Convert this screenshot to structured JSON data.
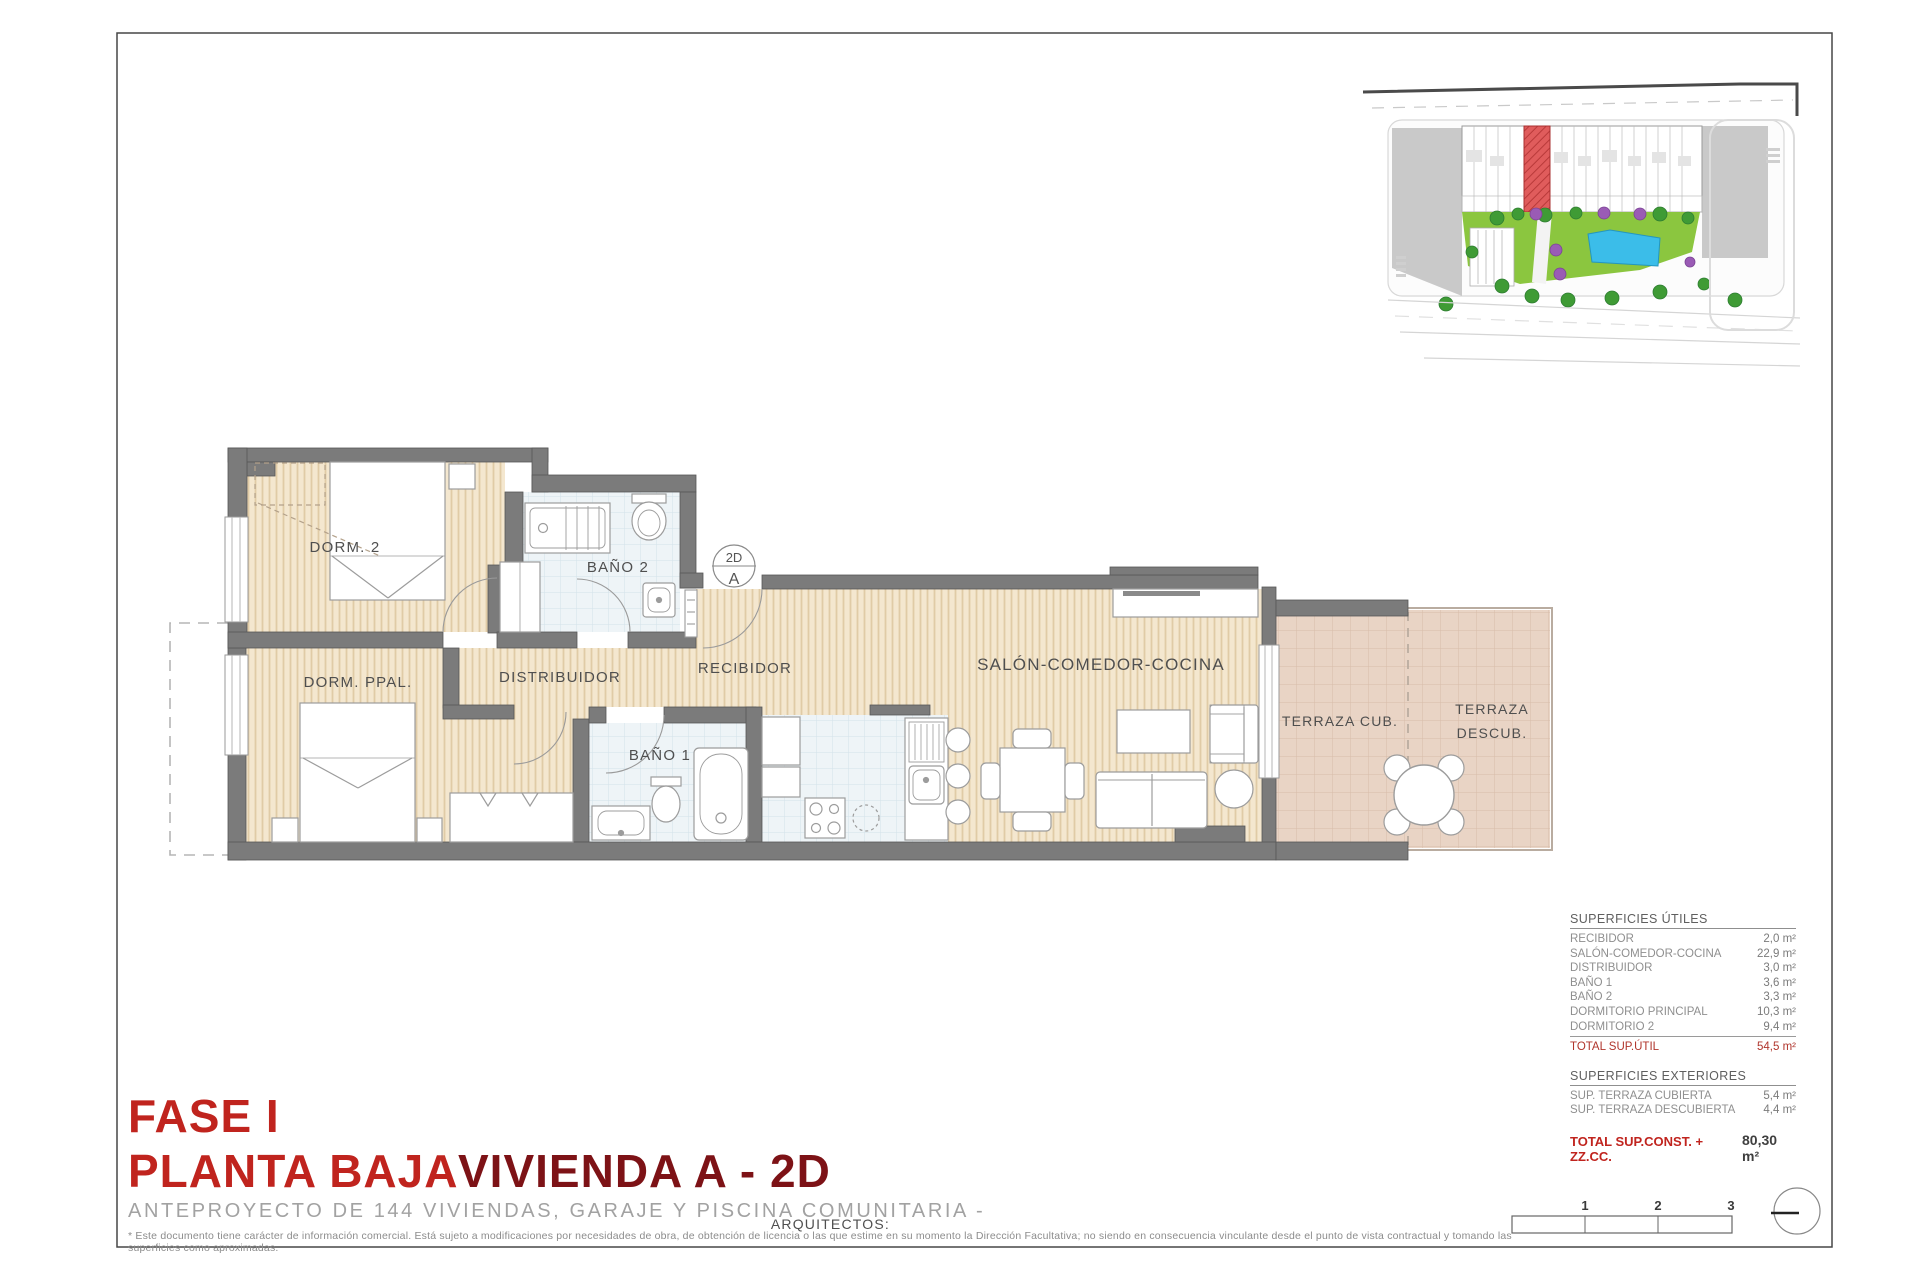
{
  "titles": {
    "phase": "FASE I",
    "floor": "PLANTA BAJA",
    "unit": "VIVIENDA A - 2D",
    "subtitle": "ANTEPROYECTO DE 144 VIVIENDAS, GARAJE Y PISCINA COMUNITARIA -",
    "architects": "ARQUITECTOS:",
    "disclaimer": "* Este documento tiene carácter de información comercial. Está sujeto a modificaciones por necesidades de obra, de obtención de licencia o las que estime en su momento la Dirección Facultativa; no siendo en consecuencia vinculante desde el punto de vista contractual y tomando las superficies como aproximadas."
  },
  "plan": {
    "labels": {
      "dorm2": "DORM. 2",
      "bano2": "BAÑO 2",
      "dorm_ppal": "DORM. PPAL.",
      "distribuidor": "DISTRIBUIDOR",
      "recibidor": "RECIBIDOR",
      "bano1": "BAÑO 1",
      "salon": "SALÓN-COMEDOR-COCINA",
      "terraza_cub": "TERRAZA CUB.",
      "terraza_descub_line1": "TERRAZA",
      "terraza_descub_line2": "DESCUB."
    },
    "marker": {
      "top": "2D",
      "bottom": "A"
    }
  },
  "surfaces": {
    "utiles": {
      "title": "SUPERFICIES ÚTILES",
      "rows": [
        {
          "label": "RECIBIDOR",
          "value": "2,0 m²"
        },
        {
          "label": "SALÓN-COMEDOR-COCINA",
          "value": "22,9 m²"
        },
        {
          "label": "DISTRIBUIDOR",
          "value": "3,0 m²"
        },
        {
          "label": "BAÑO 1",
          "value": "3,6 m²"
        },
        {
          "label": "BAÑO 2",
          "value": "3,3 m²"
        },
        {
          "label": "DORMITORIO PRINCIPAL",
          "value": "10,3 m²"
        },
        {
          "label": "DORMITORIO 2",
          "value": "9,4 m²"
        }
      ],
      "total": {
        "label": "TOTAL SUP.ÚTIL",
        "value": "54,5 m²"
      }
    },
    "exteriores": {
      "title": "SUPERFICIES EXTERIORES",
      "rows": [
        {
          "label": "SUP. TERRAZA CUBIERTA",
          "value": "5,4 m²"
        },
        {
          "label": "SUP. TERRAZA DESCUBIERTA",
          "value": "4,4 m²"
        }
      ],
      "total": {
        "label": "TOTAL SUP.CONST. + ZZ.CC.",
        "value": "80,30 m²"
      }
    }
  },
  "scalebar": {
    "ticks": [
      "1",
      "2",
      "3"
    ]
  },
  "colors": {
    "accent_red": "#c0241e",
    "dark_red": "#7d1216",
    "wall_gray": "#7b7b7b",
    "wood_floor": "#f4e7cf",
    "bath_floor": "#eef4f7",
    "terrace_floor": "#e9d4c5",
    "table_total_red": "#b0352c",
    "highlight_unit_red": "#e05c5c",
    "pool_blue": "#3bbde9",
    "garden_green": "#8bc63f"
  }
}
